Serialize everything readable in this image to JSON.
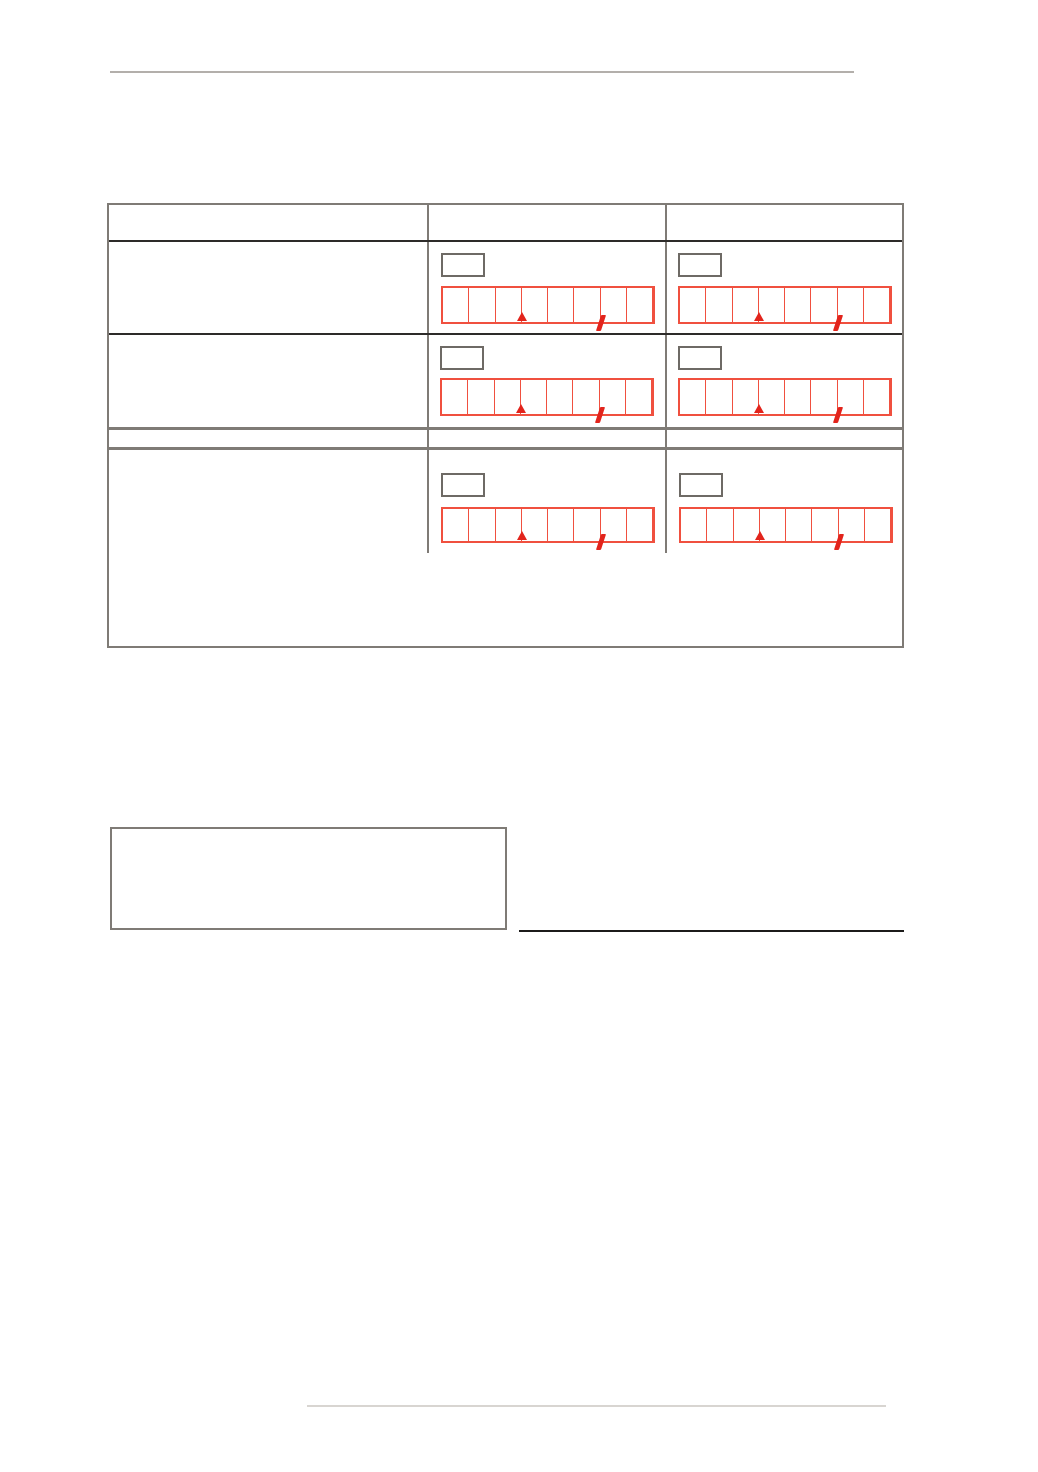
{
  "page": {
    "width": 1038,
    "height": 1472,
    "background": "#ffffff"
  },
  "rules": {
    "top_rule_color": "#b3afab",
    "bottom_rule_color": "#d8d5d1"
  },
  "form_table": {
    "border_color": "#7f7b76",
    "dark_line_color": "#2d2b29",
    "header": {
      "col1": "",
      "col2": "",
      "col3": ""
    },
    "rows": [
      {
        "label": "",
        "col2": {
          "code": "",
          "amount": ""
        },
        "col3": {
          "code": "",
          "amount": ""
        }
      },
      {
        "label": "",
        "col2": {
          "code": "",
          "amount": ""
        },
        "col3": {
          "code": "",
          "amount": ""
        }
      },
      {
        "label": "",
        "col2": {
          "code": "",
          "amount": ""
        },
        "col3": {
          "code": "",
          "amount": ""
        }
      }
    ],
    "amount_format": {
      "digit_cells": 8,
      "thousands_marker_after": 3,
      "decimal_marker_after": 6,
      "decimal_glyph": ",",
      "cell_border_color": "#f0503f",
      "marker_color": "#e2241c",
      "code_box_border_color": "#6e6a65"
    }
  },
  "notes_box": {
    "value": "",
    "border_color": "#7f7b76"
  },
  "signature_line": {
    "color": "#1c1b1a"
  }
}
